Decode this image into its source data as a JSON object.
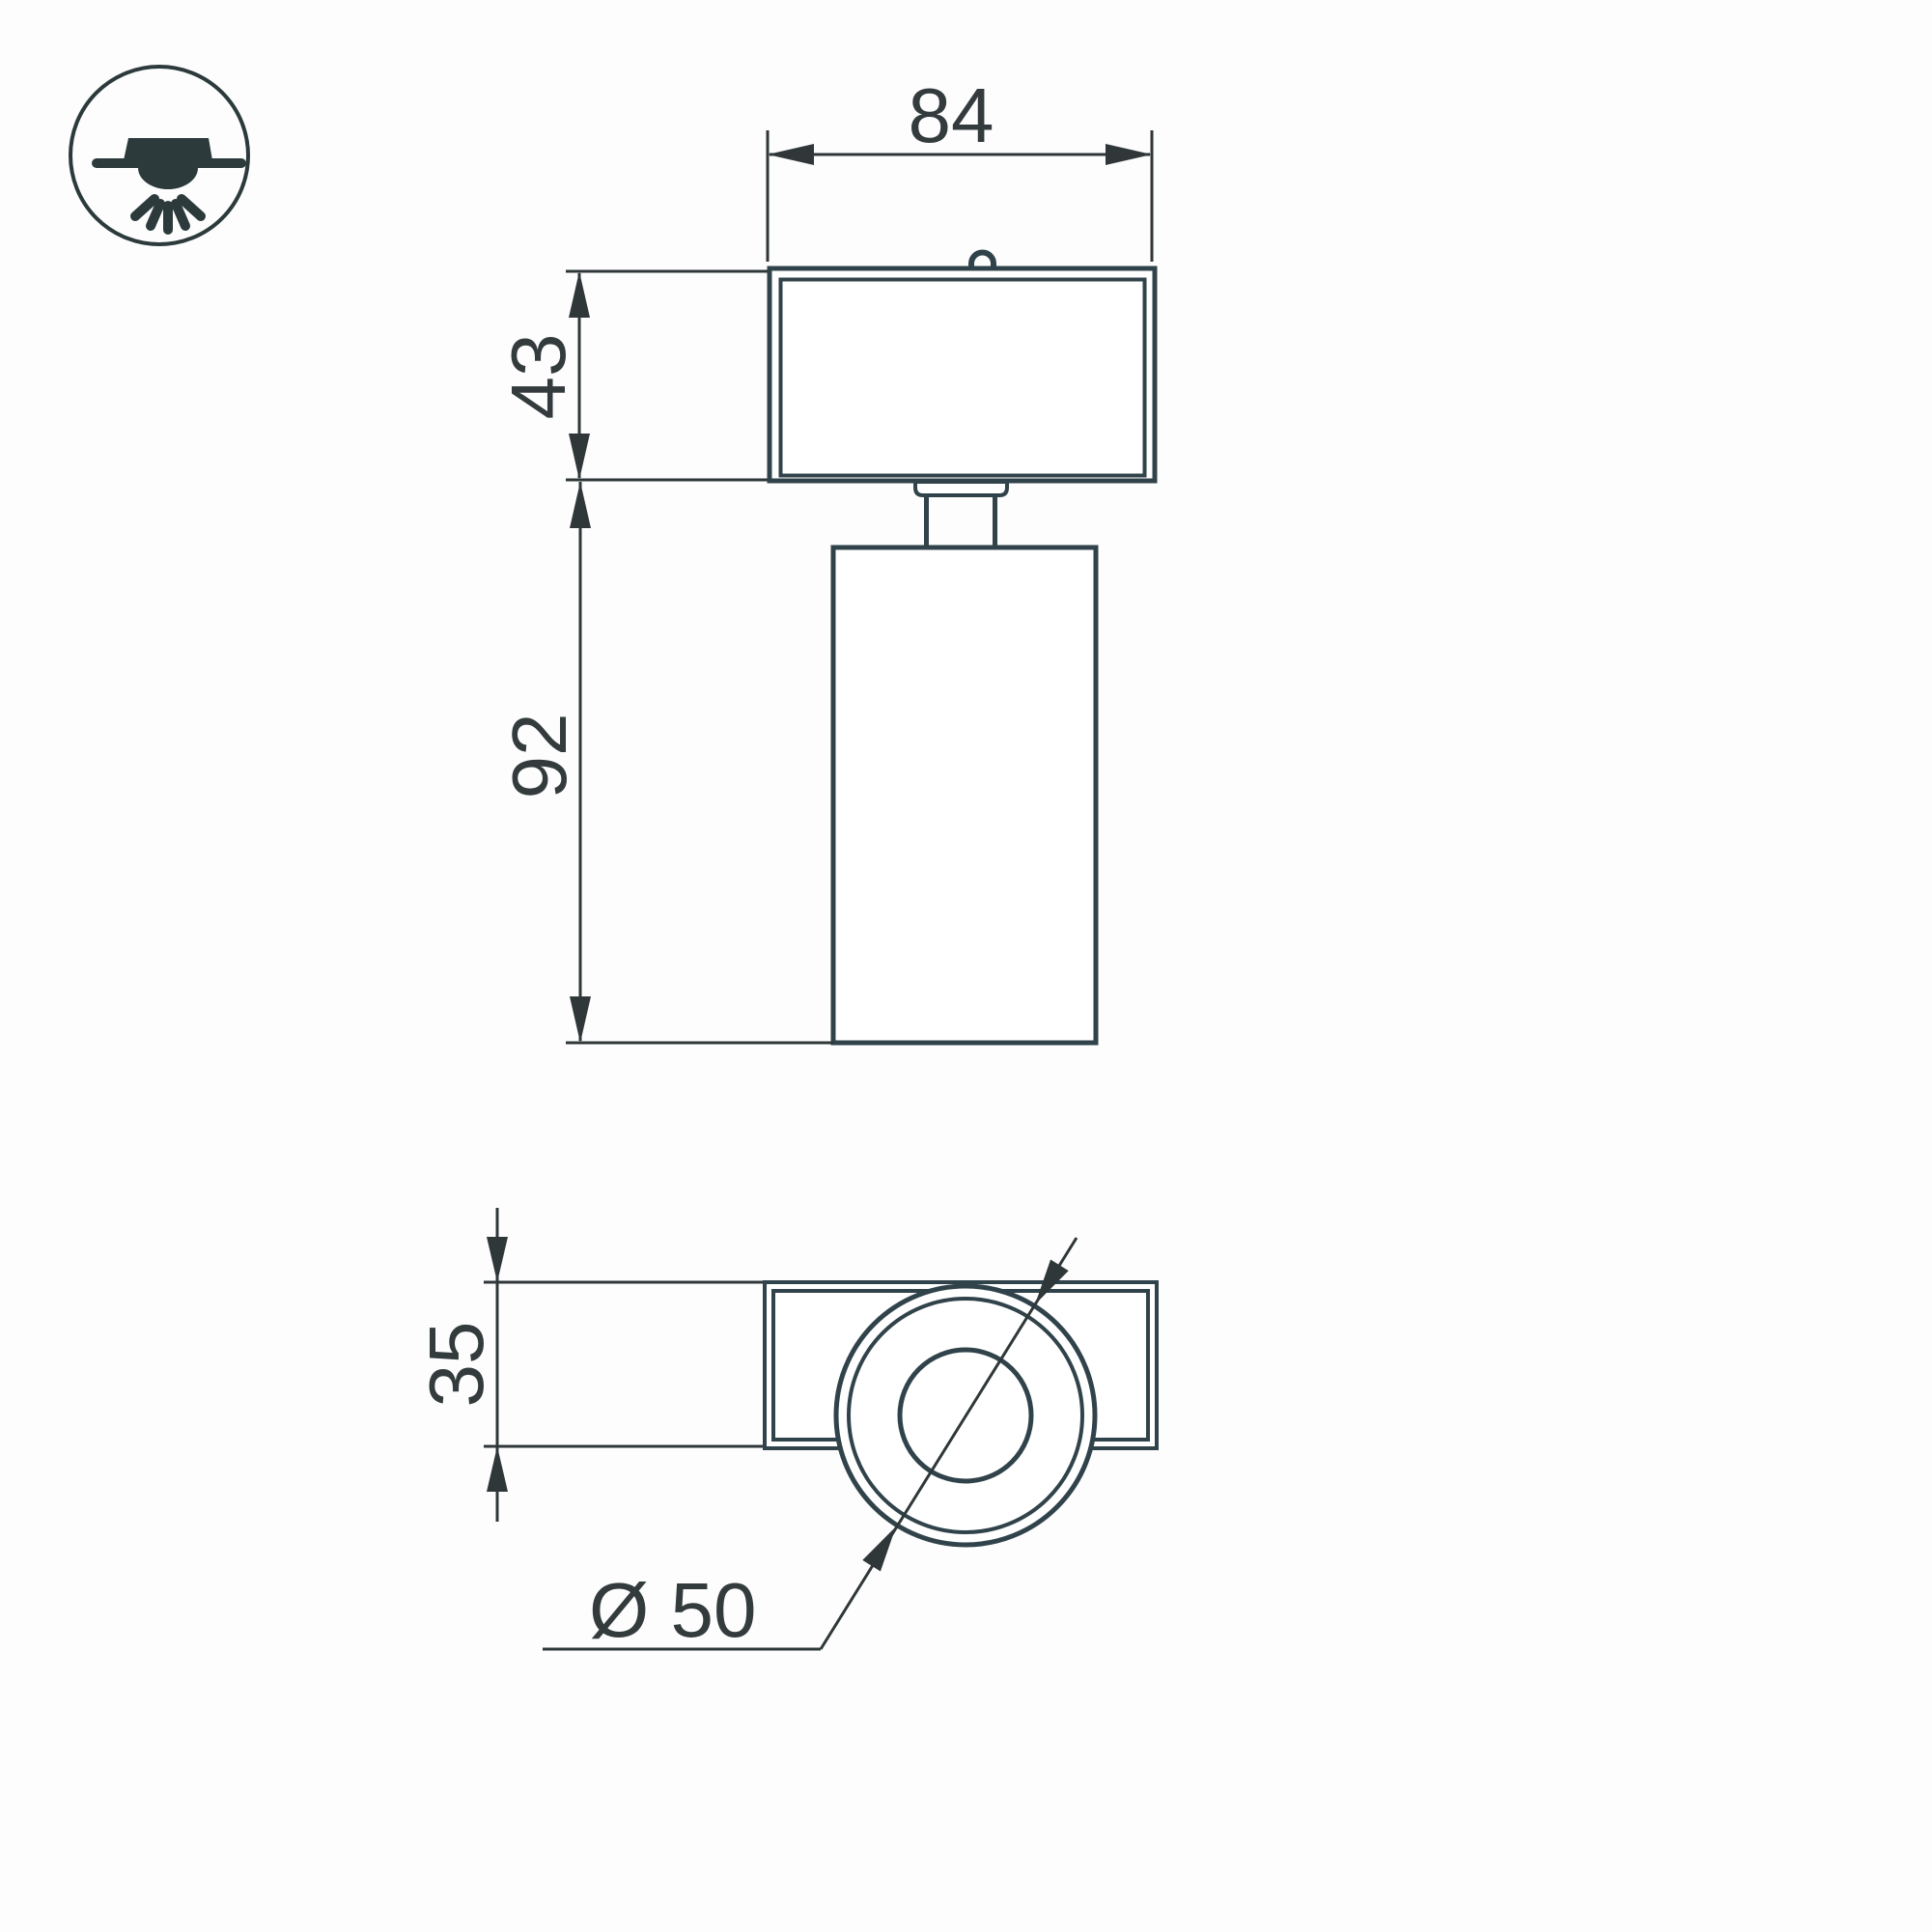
{
  "drawing_title": "spot-luminaire-dimension-drawing",
  "colors": {
    "outline": "#31434a",
    "dimension_lines": "#2f3739",
    "text": "#333b3d",
    "background": "#fdfdfd",
    "shape_fill": "#ffffff"
  },
  "front_view": {
    "width_mm": "84",
    "mount_height_mm": "43",
    "body_height_mm": "92"
  },
  "top_view": {
    "depth_mm": "35",
    "diameter_mm": "Ø 50"
  },
  "legend_icon": {
    "meaning": "surface-mounted-ceiling-luminaire"
  }
}
